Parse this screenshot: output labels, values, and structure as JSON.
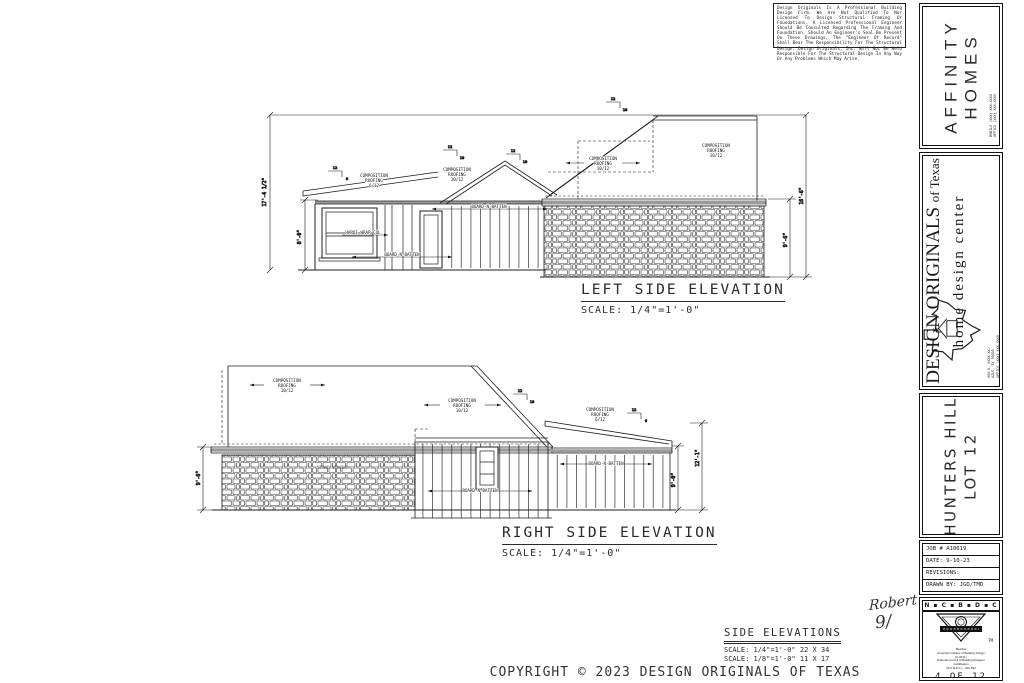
{
  "disclaimer": "Design Originals Is A Professional Building Design Firm. We Are Not Qualified To Nor Licensed To Design Structural Framing Or Foundations. A Licensed Professional Engineer Should Be Consulted Regarding The Framing And Foundation. Should An Engineer's Seal Be Present On These Drawings, The \"Engineer Of Record\" Shall Bear The Responsibility For The Structural Design. Design Originals, Inc. Will Not Be Held Responsible For The Structural Design In Any Way Or Any Problems Which May Arise.",
  "titleblock": {
    "builder": {
      "line1": "AFFINITY",
      "line2": "HOMES",
      "contact": [
        "MOBILE (XXX) XXX-XXXX",
        "OFFICE (XXX) XXX-XXXX"
      ]
    },
    "designer": {
      "name": "DESIGN ORIGINALS",
      "suffix": "of Texas",
      "tagline": "home design center",
      "address": [
        "XXX X. XXXX XX.",
        "AZLE, TX 76020",
        "OFFICE (XXX) XXX-XXXX"
      ]
    },
    "project": {
      "line1": "HUNTERS HILL",
      "line2": "LOT 12"
    },
    "job": {
      "number": "JOB # A10619",
      "date": "DATE: 9-10-23",
      "revisions": "REVISIONS:",
      "drawn_by": "DRAWN BY: JGD/TMD"
    },
    "cert": {
      "header": "N ▪ C ▪ B ▪ D ▪ C",
      "tm": "TM",
      "member_lines": [
        "Member",
        "American Institute of Building Design",
        "(A.I.B.D.)",
        "National Council of Building Designer",
        "Certification",
        "(N.C.B.D.C.) - #01-593"
      ],
      "sheet": "4 OF 12"
    }
  },
  "signature": {
    "name": "Robert",
    "number": "9/"
  },
  "elevations": {
    "left": {
      "title": "LEFT SIDE ELEVATION",
      "scale": "SCALE: 1/4\"=1'-0\"",
      "dims": {
        "overall_height": "17'-4 1/2\"",
        "plate_height": "8'-0\"",
        "right_overall": "16'-6\"",
        "right_plate": "9'-6\""
      }
    },
    "right": {
      "title": "RIGHT SIDE ELEVATION",
      "scale": "SCALE: 1/4\"=1'-0\"",
      "dims": {
        "left_plate": "9'-6\"",
        "right_plate": "9'-0\"",
        "right_overall": "12'-1\""
      }
    }
  },
  "labels": {
    "composition": "COMPOSITION",
    "roofing": "ROOFING",
    "pitch_6": "6/12",
    "pitch_10": "10/12",
    "board_batten": "BOARD-N-BATTEN",
    "hardi": "HARDI WRAP COL",
    "stone": "STONE VENEER",
    "rise": "12",
    "run6": "6",
    "run10": "10"
  },
  "footer": {
    "title": "SIDE ELEVATIONS",
    "scale1": "SCALE: 1/4\"=1'-0\"  22 X 34",
    "scale2": "SCALE: 1/8\"=1'-0\"  11 X 17"
  },
  "copyright": "COPYRIGHT © 2023 DESIGN ORIGINALS OF TEXAS"
}
